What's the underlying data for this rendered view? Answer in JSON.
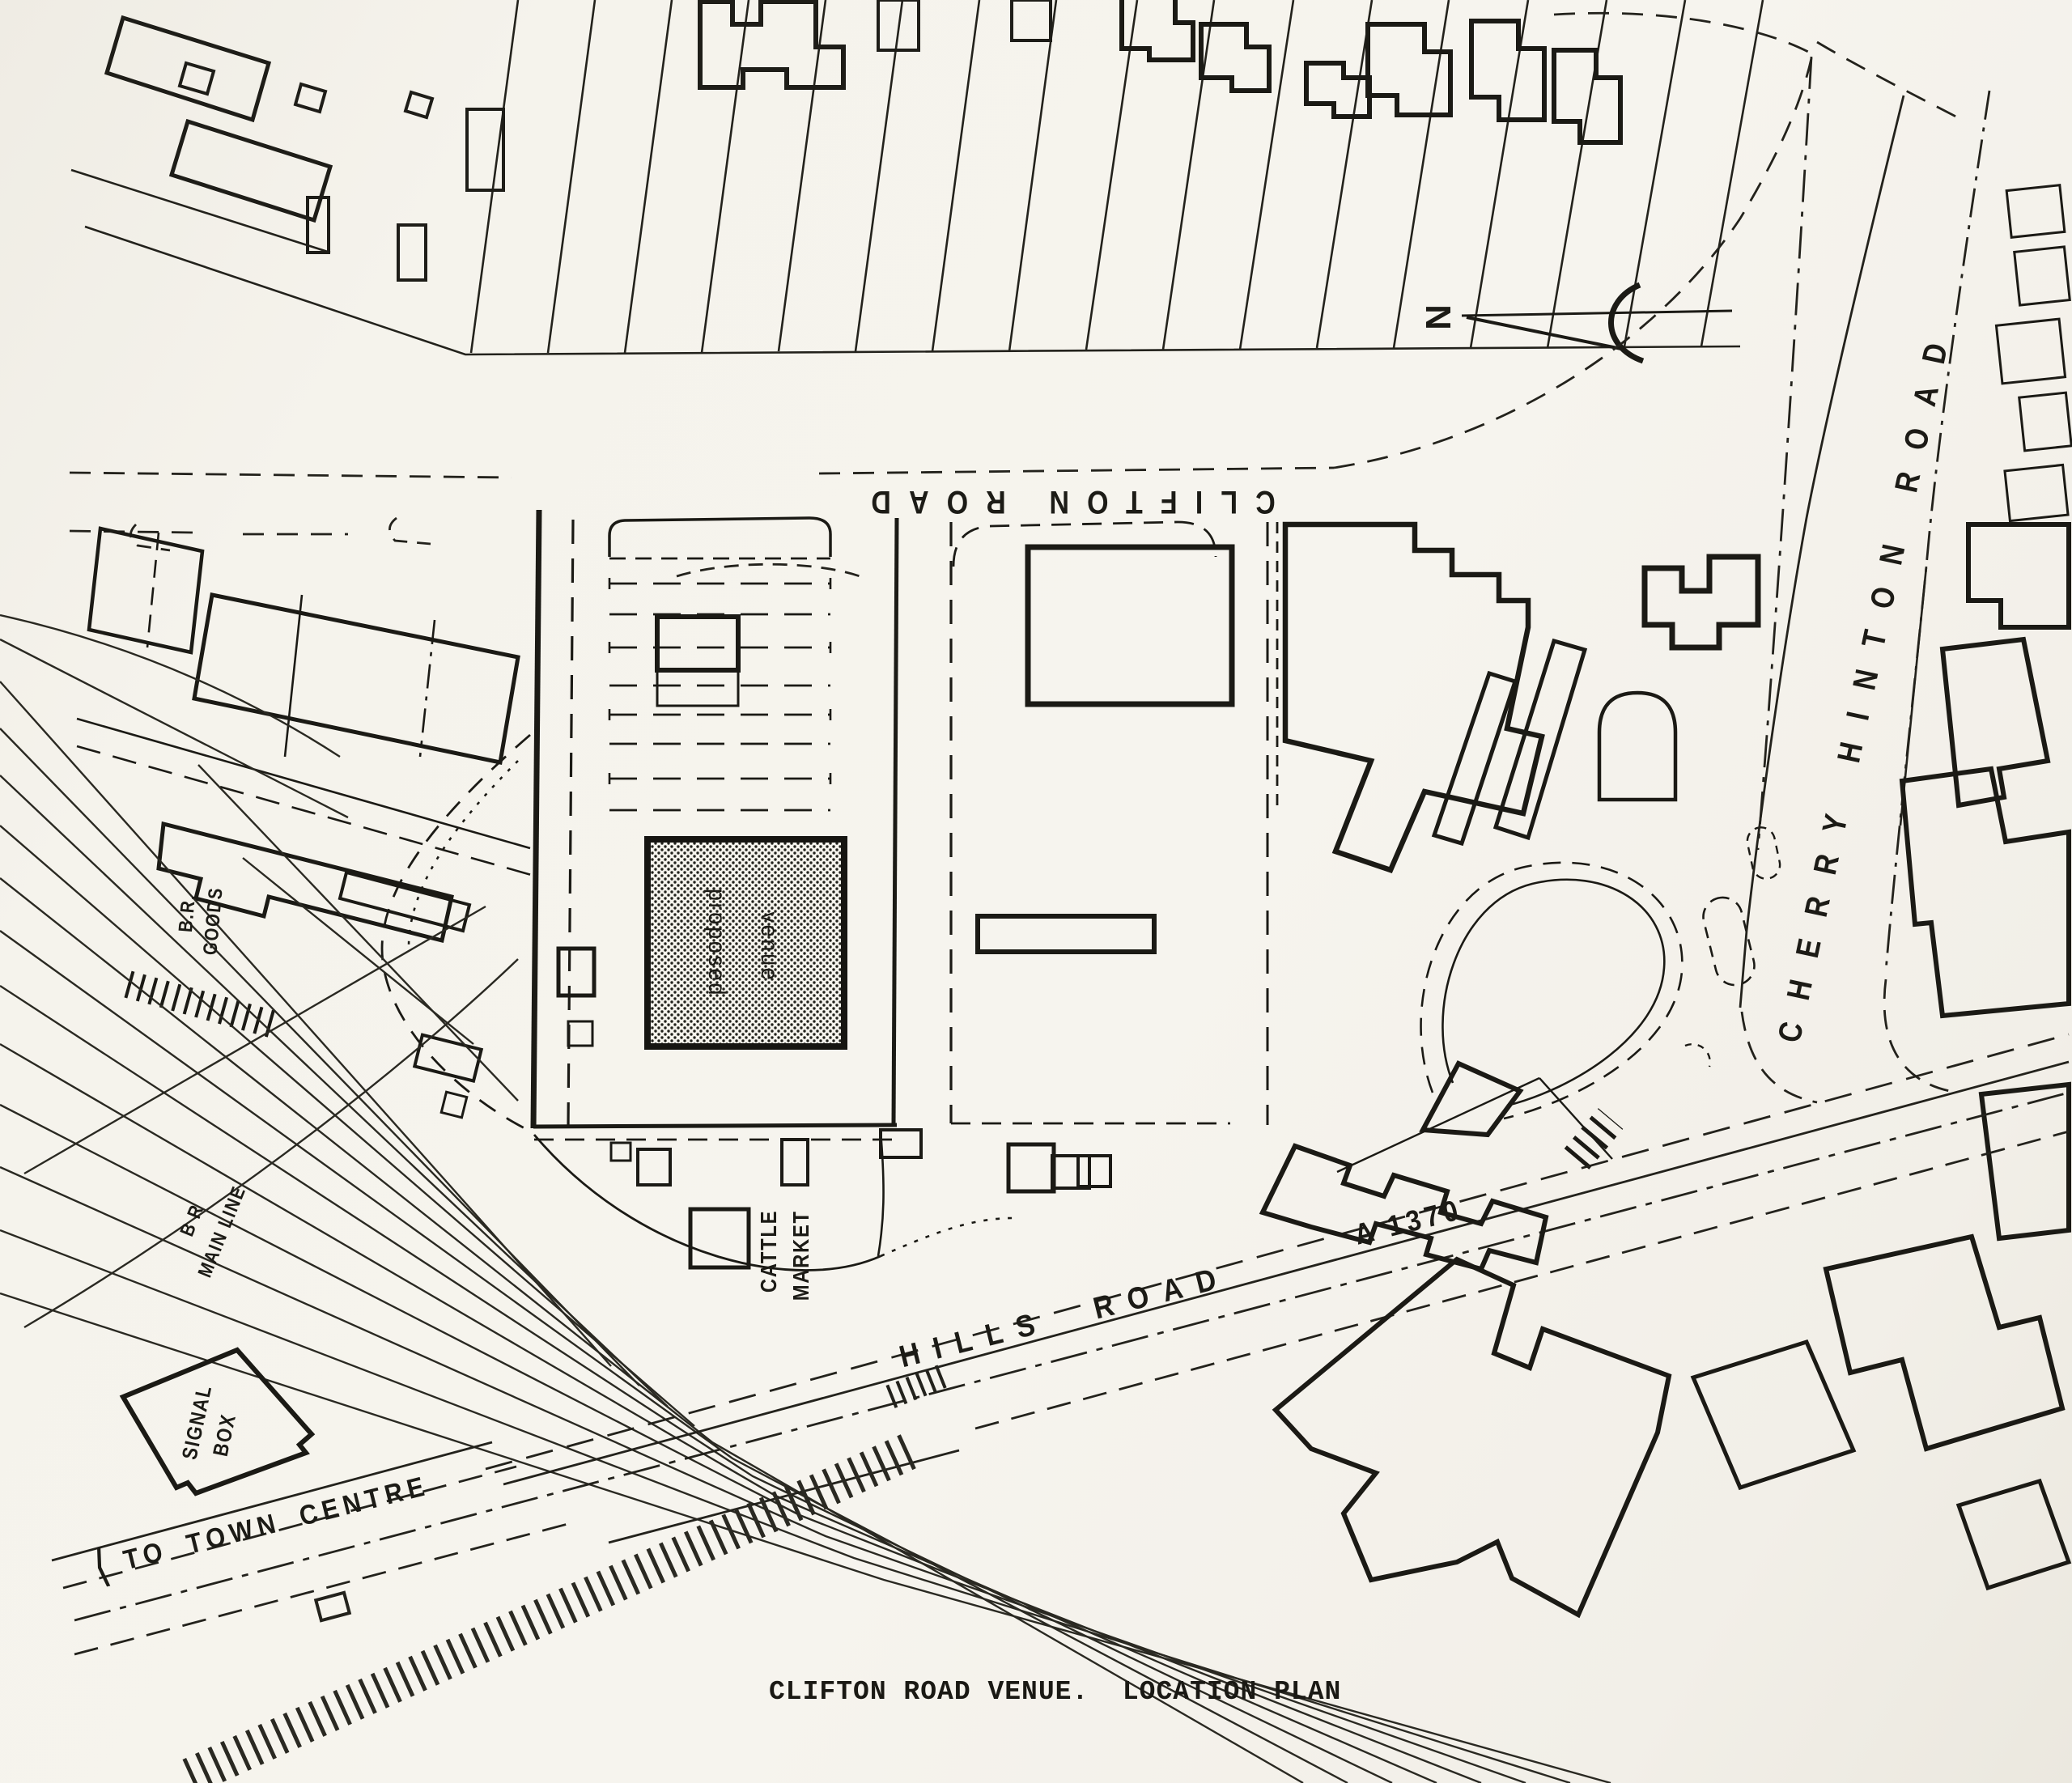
{
  "map": {
    "caption": "CLIFTON ROAD VENUE.  LOCATION PLAN",
    "north_label": "N",
    "roads": {
      "clifton": "CLIFTON ROAD",
      "cherry_hinton": "CHERRY HINTON ROAD",
      "hills": "HILLS ROAD",
      "hills_number": "A 1370",
      "town_centre_arrow": "⟨",
      "town_centre": "TO TOWN CENTRE"
    },
    "labels": {
      "proposed_venue_word1": "proposed",
      "proposed_venue_word2": "venue",
      "cattle_market_line1": "CATTLE",
      "cattle_market_line2": "MARKET",
      "signal_box_line1": "SIGNAL",
      "signal_box_line2": "BOX",
      "br_goods_line1": "B.R.",
      "br_goods_line2": "GOODS",
      "br_main_line1": "B R",
      "br_main_line2": "MAIN LINE"
    },
    "colors": {
      "paper": "#f4f2ec",
      "ink": "#1b1b16"
    }
  }
}
